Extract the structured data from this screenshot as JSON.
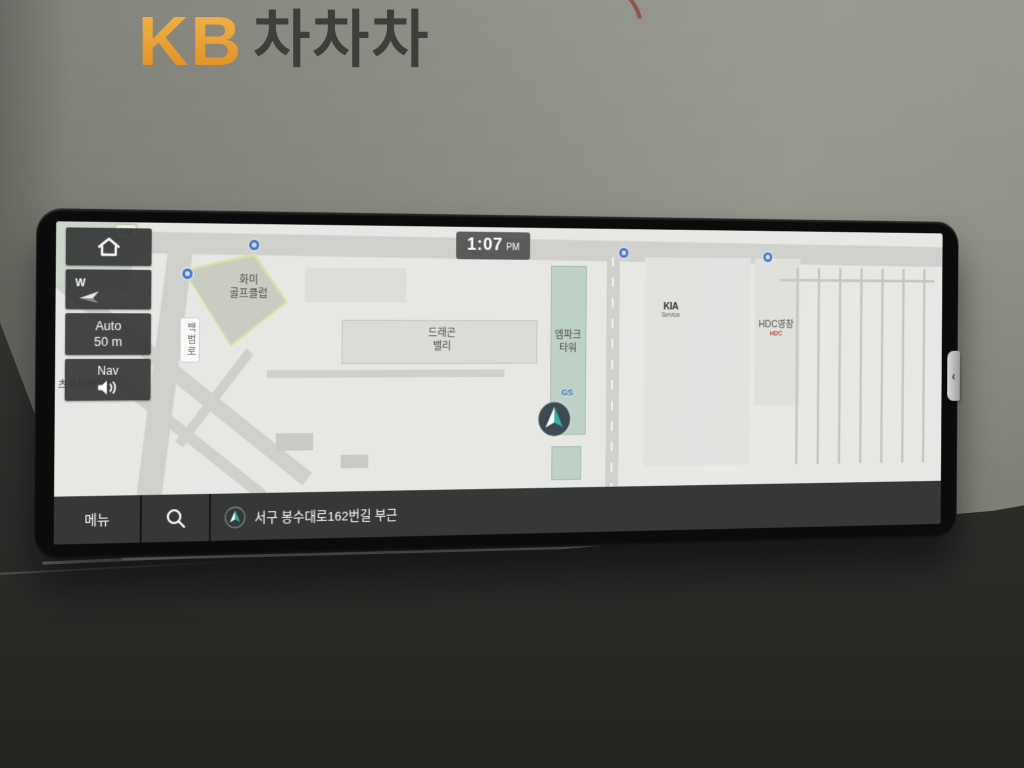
{
  "brand": {
    "kb": "KB",
    "name": "차차차"
  },
  "colors": {
    "brand_orange": "#efa83c",
    "brand_text": "#3e3e3b",
    "marker_teal": "#2fb1a5",
    "map_background": "#e7e8e4",
    "ui_dark": "#343635",
    "hdc_red": "#c44536",
    "gs_blue": "#2f6bb3",
    "poi_blue": "#4a79c8"
  },
  "screen": {
    "status": {
      "time": "1:07",
      "meridiem": "PM"
    },
    "sidebar": {
      "home_icon": "home",
      "compass_label": "W",
      "scale_text": "Auto\n50 m",
      "nav_label": "Nav"
    },
    "map": {
      "cu_badge": "CU",
      "golf_club": "화미\n골프클럽",
      "road_baekbeom": "백범로",
      "dragon_valley": "드래곤\n밸리",
      "mpark_tower": "엠파크\n타워",
      "gs_station": "GS",
      "kia_brand": "KIA",
      "kia_service": "Service",
      "hdc_label": "HDC영창",
      "hdc_logo": "HDC",
      "corp_label": "츠코퍼레이션"
    },
    "bottombar": {
      "menu_label": "메뉴",
      "address": "서구 봉수대로162번길 부근"
    },
    "panel_handle": "‹"
  }
}
